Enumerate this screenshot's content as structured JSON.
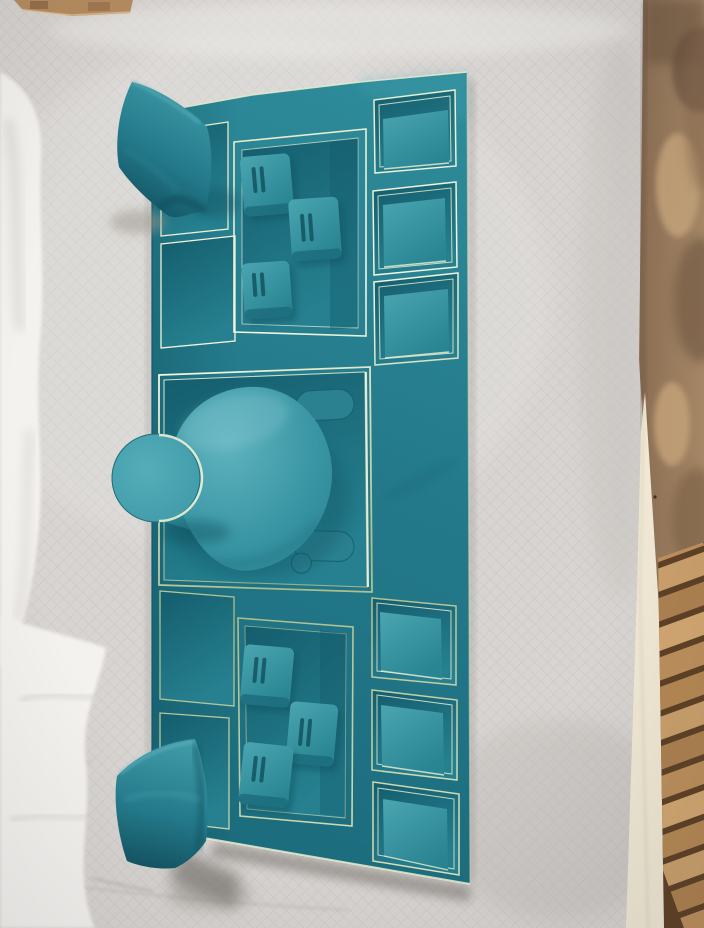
{
  "scene": {
    "type": "photograph",
    "subject": "Teal velvet jewelry display set with gold trim, photographed top-down on a grey diamond-quilted blanket",
    "objects": [
      {
        "id": "display-board",
        "label": "teal velvet jewelry display board with gold pinstripe trim"
      },
      {
        "id": "bracelet-pillow-top",
        "label": "teal velvet bracelet pillow resting on upper-left corner"
      },
      {
        "id": "bracelet-pillow-bottom",
        "label": "teal velvet bracelet pillow resting on lower-left corner"
      },
      {
        "id": "necklace-bust",
        "label": "velvet necklace display bust lying flat in centre recess"
      },
      {
        "id": "ring-tray-upper",
        "label": "upper ring tray holding three slotted ring cushions"
      },
      {
        "id": "ring-tray-lower",
        "label": "lower ring tray holding three slotted ring cushions"
      },
      {
        "id": "square-trays-right",
        "label": "six square cushion trays along right edge",
        "count": 6
      },
      {
        "id": "side-trays-left",
        "label": "four plain recessed trays along left edge",
        "count": 4
      },
      {
        "id": "earring-paddles",
        "label": "two flat earring paddles in centre recess",
        "count": 2
      },
      {
        "id": "quilted-blanket",
        "label": "grey diamond-quilted blanket backdrop"
      },
      {
        "id": "sheer-cloth",
        "label": "white cloth draped along left edge"
      },
      {
        "id": "distressed-panel",
        "label": "mottled brown distressed panel along right edge"
      },
      {
        "id": "wood-planks",
        "label": "wooden plank floor visible at bottom-right corner"
      },
      {
        "id": "table-edge",
        "label": "cream table edge strip on right side"
      },
      {
        "id": "wood-strip-top",
        "label": "small wooden strip at top edge"
      }
    ]
  },
  "palette": {
    "blanket_grey": "#d7d4d1",
    "blanket_grey_line": "#c7c3c0",
    "white_cloth": "#f4f2ef",
    "board_teal_light": "#2f8d9b",
    "board_teal": "#23798a",
    "board_teal_deep": "#1b6c7d",
    "recess_teal_dark": "#145d6d",
    "recess_teal": "#26808f",
    "cushion_teal_light": "#4aa5b1",
    "cushion_teal": "#2a8593",
    "bust_teal_light": "#60b3bf",
    "bust_teal": "#3a96a4",
    "gold_bright": "#f5f7e3",
    "gold": "#dfe7c2",
    "gold_dim": "#a9bd8c",
    "pillow_teal_light": "#3f9aa7",
    "pillow_teal_dark": "#114f5e",
    "shadow_grey": "#5f5a54",
    "panel_brown": "#a98a68",
    "panel_brown_dark": "#6a5340",
    "table_cream": "#f0e8d4",
    "plank_wood": "#bd8f5c",
    "plank_gap": "#5e4126"
  }
}
